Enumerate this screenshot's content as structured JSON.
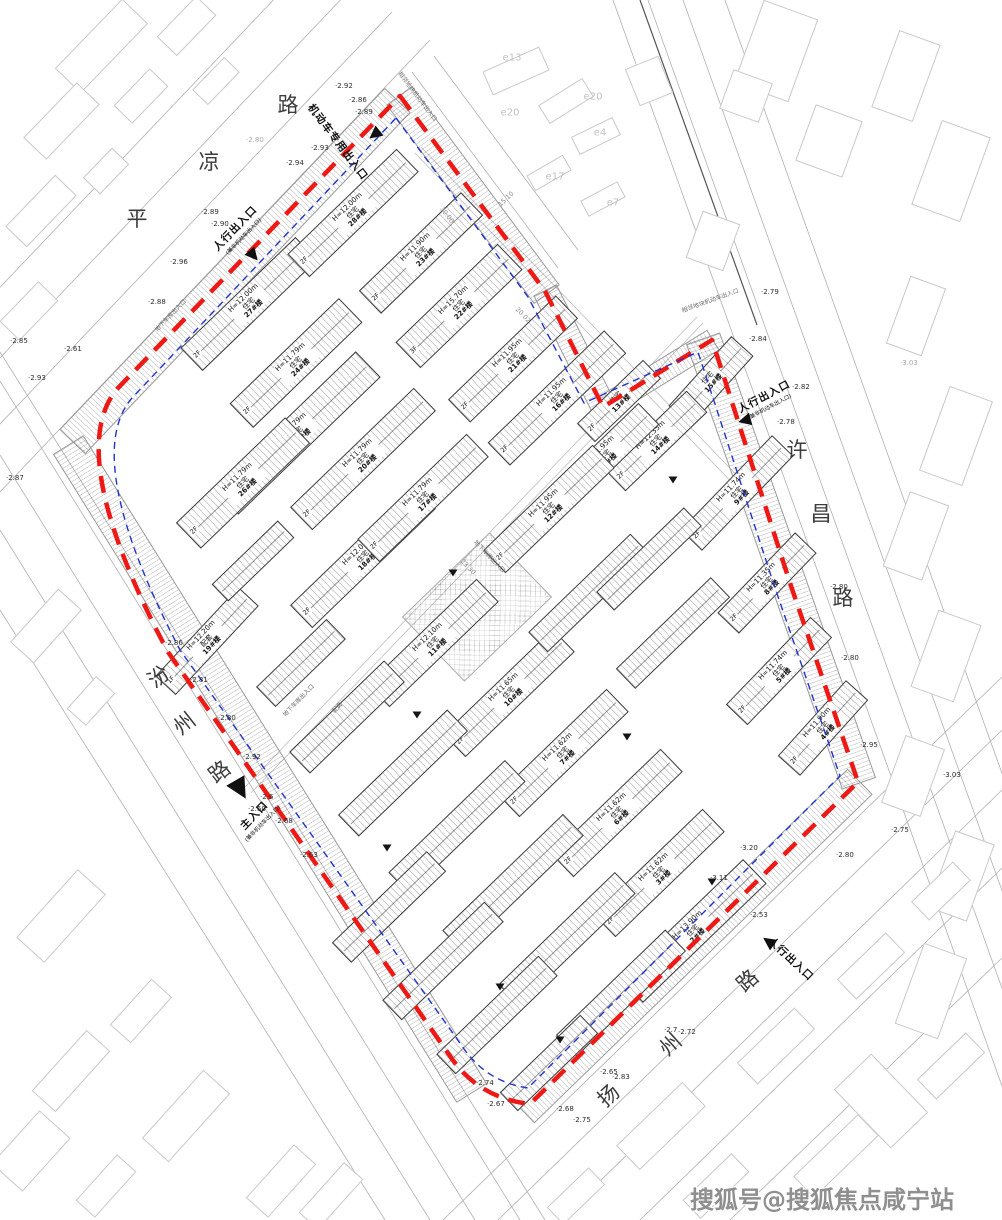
{
  "site": {
    "watermark": "搜狐号@搜狐焦点咸宁站"
  },
  "boundary": {
    "red_color": "#ee1814",
    "blue_color": "#2233cc",
    "red_path": "M400,96 L545,291 L603,407 L712,340 L790,583 L858,782 L530,1104 Q478,1098 450,1056 L168,652 Q62,452 118,388 Z",
    "blue_path": "M396,118 L528,297 L584,403 L698,352 L774,585 L840,776 L528,1088 Q486,1082 462,1046 L180,650 Q80,458 132,398 Z"
  },
  "roads": [
    {
      "name": "平凉路",
      "chars": [
        [
          "平",
          137,
          218,
          0
        ],
        [
          "凉",
          209,
          161,
          0
        ],
        [
          "路",
          288,
          104,
          0
        ]
      ]
    },
    {
      "name": "许昌路",
      "chars": [
        [
          "许",
          797,
          449,
          0
        ],
        [
          "昌",
          821,
          513,
          0
        ],
        [
          "路",
          843,
          597,
          0
        ]
      ]
    },
    {
      "name": "汾州路",
      "chars": [
        [
          "汾",
          158,
          676,
          -38
        ],
        [
          "州",
          184,
          723,
          -38
        ],
        [
          "路",
          219,
          771,
          -38
        ]
      ]
    },
    {
      "name": "扬州路",
      "chars": [
        [
          "扬",
          608,
          1095,
          -42
        ],
        [
          "州",
          670,
          1044,
          -42
        ],
        [
          "路",
          747,
          980,
          -42
        ]
      ]
    }
  ],
  "entrances": [
    {
      "label": "人行出入口",
      "sub": "(兼非机动车出入口)",
      "x": 238,
      "y": 231,
      "rot": -46,
      "tri": [
        253,
        255,
        140,
        13
      ]
    },
    {
      "label": "机动车专用出入口",
      "sub": "",
      "x": 338,
      "y": 142,
      "rot": 53,
      "tri": [
        374,
        134,
        232,
        13
      ]
    },
    {
      "label": "人行出入口",
      "sub": "(兼非机动车出入口)",
      "x": 766,
      "y": 400,
      "rot": -28,
      "tri": [
        744,
        420,
        255,
        13
      ]
    },
    {
      "label": "主入口",
      "sub": "(兼非机动车出入口)",
      "x": 257,
      "y": 818,
      "rot": -46,
      "tri": [
        240,
        789,
        150,
        21
      ]
    },
    {
      "label": "人行出入口",
      "sub": "",
      "x": 791,
      "y": 959,
      "rot": 43,
      "tri": [
        768,
        941,
        305,
        13
      ]
    }
  ],
  "buildings": [
    {
      "num": "27#楼",
      "use": "住宅",
      "h": "H=12.00m",
      "x": 248,
      "y": 303,
      "l": 158,
      "w": 30,
      "rot": -44,
      "fl": "2F"
    },
    {
      "num": "28#楼",
      "use": "住宅",
      "h": "H=12.00m",
      "x": 352,
      "y": 212,
      "l": 150,
      "w": 30,
      "rot": -44,
      "fl": "2F"
    },
    {
      "num": "23#楼",
      "use": "住宅",
      "h": "H=11.90m",
      "x": 420,
      "y": 252,
      "l": 140,
      "w": 30,
      "rot": -44,
      "fl": "2F"
    },
    {
      "num": "22#楼",
      "use": "住宅",
      "h": "H=15.70m",
      "x": 458,
      "y": 305,
      "l": 140,
      "w": 34,
      "rot": -44,
      "fl": "3F"
    },
    {
      "num": "21#楼",
      "use": "住宅",
      "h": "H=11.95m",
      "x": 512,
      "y": 358,
      "l": 148,
      "w": 30,
      "rot": -44,
      "fl": "2F"
    },
    {
      "num": "24#楼",
      "use": "住宅",
      "h": "H=11.79m",
      "x": 295,
      "y": 362,
      "l": 150,
      "w": 32,
      "rot": -44,
      "fl": "2F"
    },
    {
      "num": "25#楼",
      "use": "住宅",
      "h": "H=11.79m",
      "x": 296,
      "y": 432,
      "l": 196,
      "w": 34,
      "rot": -44,
      "fl": "2F"
    },
    {
      "num": "26#楼",
      "use": "住宅",
      "h": "H=11.79m",
      "x": 242,
      "y": 482,
      "l": 150,
      "w": 34,
      "rot": -44,
      "fl": "2F"
    },
    {
      "num": "20#楼",
      "use": "住宅",
      "h": "H=11.79m",
      "x": 362,
      "y": 458,
      "l": 170,
      "w": 30,
      "rot": -44,
      "fl": "2F"
    },
    {
      "num": "18#楼",
      "use": "住宅",
      "h": "H=12.00m",
      "x": 362,
      "y": 556,
      "l": 170,
      "w": 30,
      "rot": -44,
      "fl": "2F"
    },
    {
      "num": "17#楼",
      "use": "住宅",
      "h": "H=11.79m",
      "x": 422,
      "y": 497,
      "l": 150,
      "w": 30,
      "rot": -44,
      "fl": "2F"
    },
    {
      "num": "16#楼",
      "use": "住宅",
      "h": "H=11.95m",
      "x": 556,
      "y": 397,
      "l": 160,
      "w": 30,
      "rot": -44,
      "fl": "2F"
    },
    {
      "num": "15#楼",
      "use": "住宅",
      "h": "",
      "x": 710,
      "y": 380,
      "l": 92,
      "w": 28,
      "rot": -48,
      "fl": "3F"
    },
    {
      "num": "14#楼",
      "use": "住宅",
      "h": "H=12.35m",
      "x": 655,
      "y": 440,
      "l": 112,
      "w": 28,
      "rot": -44,
      "fl": "2F"
    },
    {
      "num": "13#楼",
      "use": "住宅",
      "h": "",
      "x": 618,
      "y": 400,
      "l": 90,
      "w": 24,
      "rot": -44,
      "fl": "2F"
    },
    {
      "num": "1#楼",
      "use": "住宅",
      "h": "H=11.95m",
      "x": 604,
      "y": 455,
      "l": 120,
      "w": 28,
      "rot": -44,
      "fl": "2F"
    },
    {
      "num": "12#楼",
      "use": "住宅",
      "h": "H=11.95m",
      "x": 548,
      "y": 508,
      "l": 150,
      "w": 30,
      "rot": -44,
      "fl": "2F"
    },
    {
      "num": "11#楼",
      "use": "住宅",
      "h": "H=12.10m",
      "x": 432,
      "y": 642,
      "l": 150,
      "w": 30,
      "rot": -44,
      "fl": "2F"
    },
    {
      "num": "10#楼",
      "use": "住宅",
      "h": "H=11.65m",
      "x": 508,
      "y": 692,
      "l": 150,
      "w": 30,
      "rot": -44,
      "fl": "2F"
    },
    {
      "num": "9#楼",
      "use": "住宅",
      "h": "H=11.74m",
      "x": 736,
      "y": 492,
      "l": 130,
      "w": 28,
      "rot": -46,
      "fl": "2F"
    },
    {
      "num": "8#楼",
      "use": "住宅",
      "h": "H=11.35m",
      "x": 766,
      "y": 582,
      "l": 110,
      "w": 28,
      "rot": -46,
      "fl": "2F"
    },
    {
      "num": "5#楼",
      "use": "住宅",
      "h": "H=11.74m",
      "x": 778,
      "y": 670,
      "l": 120,
      "w": 28,
      "rot": -46,
      "fl": "2F"
    },
    {
      "num": "4#楼",
      "use": "住宅",
      "h": "H=11.90m",
      "x": 822,
      "y": 727,
      "l": 100,
      "w": 28,
      "rot": -48,
      "fl": "2F"
    },
    {
      "num": "7#楼",
      "use": "住宅",
      "h": "H=11.62m",
      "x": 562,
      "y": 752,
      "l": 150,
      "w": 30,
      "rot": -44,
      "fl": "2F"
    },
    {
      "num": "6#楼",
      "use": "住宅",
      "h": "H=11.62m",
      "x": 616,
      "y": 812,
      "l": 150,
      "w": 30,
      "rot": -44,
      "fl": "2F"
    },
    {
      "num": "3#楼",
      "use": "住宅",
      "h": "H=11.62m",
      "x": 658,
      "y": 872,
      "l": 150,
      "w": 30,
      "rot": -44,
      "fl": "2F"
    },
    {
      "num": "2#楼",
      "use": "住宅",
      "h": "H=13.90m",
      "x": 692,
      "y": 930,
      "l": 170,
      "w": 32,
      "rot": -44,
      "fl": "3F"
    },
    {
      "num": "19#楼",
      "use": "配套",
      "h": "H=12.20m",
      "x": 206,
      "y": 640,
      "l": 120,
      "w": 26,
      "rot": -47,
      "fl": "1F"
    }
  ],
  "fillers": [
    [
      300,
      662,
      96,
      26,
      -44
    ],
    [
      346,
      716,
      130,
      28,
      -44
    ],
    [
      402,
      772,
      150,
      28,
      -44
    ],
    [
      456,
      826,
      160,
      28,
      -44
    ],
    [
      512,
      882,
      166,
      28,
      -44
    ],
    [
      566,
      938,
      160,
      28,
      -44
    ],
    [
      620,
      992,
      150,
      28,
      -44
    ],
    [
      388,
      906,
      130,
      26,
      -44
    ],
    [
      442,
      960,
      140,
      26,
      -44
    ],
    [
      496,
      1014,
      140,
      26,
      -44
    ],
    [
      548,
      1062,
      110,
      24,
      -44
    ],
    [
      672,
      632,
      130,
      26,
      -44
    ],
    [
      588,
      592,
      140,
      26,
      -44
    ],
    [
      648,
      558,
      120,
      24,
      -44
    ],
    [
      252,
      560,
      90,
      22,
      -44
    ]
  ],
  "belts": [
    [
      234,
      270,
      470,
      34,
      -46.4
    ],
    [
      472,
      194,
      246,
      30,
      53.4
    ],
    [
      574,
      349,
      132,
      24,
      63.4
    ],
    [
      657,
      373,
      128,
      22,
      -31.6
    ],
    [
      780,
      560,
      470,
      34,
      70.7
    ],
    [
      690,
      945,
      470,
      34,
      -44.2
    ],
    [
      269,
      768,
      762,
      34,
      58.1
    ]
  ],
  "plaza": [
    476,
    606,
    120,
    88,
    -44
  ],
  "elevations": [
    [
      337,
      86,
      "2.92",
      0
    ],
    [
      351,
      100,
      "2.86",
      0
    ],
    [
      357,
      112,
      "2.89",
      0
    ],
    [
      313,
      148,
      "2.93",
      0
    ],
    [
      288,
      163,
      "2.94",
      0
    ],
    [
      203,
      212,
      "2.89",
      0
    ],
    [
      213,
      224,
      "2.90",
      0
    ],
    [
      172,
      262,
      "2.96",
      0
    ],
    [
      150,
      302,
      "2.88",
      0
    ],
    [
      12,
      341,
      "2.85",
      0
    ],
    [
      66,
      349,
      "2.61",
      0
    ],
    [
      30,
      378,
      "2.93",
      0
    ],
    [
      8,
      478,
      "2.87",
      0
    ],
    [
      167,
      643,
      "2.86",
      0
    ],
    [
      192,
      680,
      "2.81",
      0
    ],
    [
      220,
      718,
      "2.80",
      0
    ],
    [
      245,
      757,
      "2.92",
      0
    ],
    [
      262,
      797,
      "2.6",
      0
    ],
    [
      250,
      809,
      "2.60",
      0
    ],
    [
      277,
      821,
      "2.68",
      0
    ],
    [
      302,
      855,
      "2.63",
      0
    ],
    [
      478,
      1083,
      "2.74",
      0
    ],
    [
      489,
      1104,
      "2.67",
      0
    ],
    [
      558,
      1109,
      "2.68",
      0
    ],
    [
      575,
      1120,
      "2.75",
      0
    ],
    [
      602,
      1072,
      "2.65",
      0
    ],
    [
      614,
      1077,
      "2.83",
      0
    ],
    [
      666,
      1030,
      "2.7",
      0
    ],
    [
      680,
      1032,
      "2.72",
      0
    ],
    [
      752,
      915,
      "2.53",
      0
    ],
    [
      838,
      855,
      "2.80",
      0
    ],
    [
      893,
      830,
      "2.75",
      0
    ],
    [
      862,
      745,
      "2.95",
      0
    ],
    [
      945,
      775,
      "3.03",
      0
    ],
    [
      763,
      292,
      "2.79",
      0
    ],
    [
      751,
      339,
      "2.84",
      0
    ],
    [
      794,
      387,
      "2.82",
      0
    ],
    [
      779,
      422,
      "2.78",
      0
    ],
    [
      832,
      587,
      "2.80",
      0
    ],
    [
      843,
      658,
      "2.80",
      0
    ],
    [
      902,
      363,
      "3.03",
      1
    ],
    [
      248,
      140,
      "2.80",
      1
    ],
    [
      742,
      848,
      "3.20",
      0
    ],
    [
      712,
      878,
      "3.11",
      0
    ]
  ],
  "dims": [
    [
      506,
      199,
      -44,
      "15.10"
    ],
    [
      523,
      315,
      46,
      "20.02"
    ],
    [
      468,
      567,
      46,
      "23.30"
    ],
    [
      447,
      215,
      53,
      "30.00"
    ]
  ],
  "markers": [
    [
      453,
      573
    ],
    [
      417,
      715
    ],
    [
      387,
      848
    ],
    [
      673,
      480
    ],
    [
      712,
      882
    ],
    [
      500,
      987
    ],
    [
      627,
      737
    ],
    [
      560,
      1040
    ]
  ],
  "ext_labels": [
    [
      512,
      58,
      "e13"
    ],
    [
      510,
      113,
      "e20"
    ],
    [
      593,
      97,
      "e20"
    ],
    [
      600,
      133,
      "e4"
    ],
    [
      555,
      177,
      "e17"
    ],
    [
      613,
      203,
      "e7"
    ]
  ],
  "annotations": [
    [
      418,
      96,
      53,
      "相邻地块机动车出入口"
    ],
    [
      710,
      300,
      -20,
      "相邻地块机动车出入口"
    ],
    [
      298,
      700,
      -46,
      "地下车库出入口"
    ],
    [
      490,
      556,
      46,
      "地下车库出入口"
    ],
    [
      337,
      707,
      -46,
      "配套"
    ],
    [
      170,
      315,
      -46,
      "地下车库出入口"
    ]
  ],
  "linework": {
    "outside": [
      [
        430,
        40,
        -40,
        534
      ],
      [
        392,
        12,
        -78,
        506
      ],
      [
        348,
        -8,
        -122,
        486
      ],
      [
        300,
        -28,
        -170,
        466
      ],
      [
        412,
        72,
        558,
        268
      ],
      [
        434,
        56,
        578,
        250
      ],
      [
        613,
        0,
        1050,
        1220
      ],
      [
        648,
        0,
        1085,
        1220
      ],
      [
        683,
        0,
        1120,
        1220
      ],
      [
        725,
        0,
        1162,
        1220
      ],
      [
        0,
        352,
        545,
        1220
      ],
      [
        0,
        381,
        520,
        1220
      ],
      [
        0,
        455,
        475,
        1220
      ],
      [
        0,
        530,
        430,
        1220
      ],
      [
        0,
        610,
        385,
        1220
      ],
      [
        443,
        1220,
        1002,
        677
      ],
      [
        498,
        1220,
        1002,
        730
      ],
      [
        560,
        1220,
        1002,
        790
      ],
      [
        640,
        1220,
        1002,
        868
      ],
      [
        730,
        1220,
        1002,
        958
      ]
    ],
    "outside_dark": [
      [
        640,
        0,
        757,
        325
      ]
    ],
    "internal": [
      [
        415,
        153,
        742,
        493
      ],
      [
        421,
        147,
        748,
        487
      ],
      [
        245,
        787,
        697,
        317
      ],
      [
        251,
        793,
        703,
        323
      ]
    ]
  },
  "outside_blocks": [
    [
      100,
      45,
      95,
      34,
      -46
    ],
    [
      185,
      25,
      55,
      26,
      -46
    ],
    [
      60,
      120,
      75,
      30,
      -46
    ],
    [
      140,
      95,
      50,
      24,
      -46
    ],
    [
      40,
      210,
      70,
      28,
      -46
    ],
    [
      105,
      170,
      40,
      22,
      -46
    ],
    [
      28,
      310,
      54,
      26,
      -46
    ],
    [
      215,
      80,
      44,
      20,
      -46
    ],
    [
      45,
      625,
      70,
      30,
      -48
    ],
    [
      90,
      700,
      42,
      24,
      -48
    ],
    [
      60,
      915,
      90,
      36,
      -48
    ],
    [
      140,
      1010,
      60,
      26,
      -48
    ],
    [
      70,
      1070,
      80,
      30,
      -48
    ],
    [
      185,
      1115,
      90,
      34,
      -48
    ],
    [
      280,
      1180,
      70,
      28,
      -48
    ],
    [
      105,
      1185,
      60,
      24,
      -48
    ],
    [
      30,
      1150,
      70,
      40,
      -48
    ],
    [
      905,
      75,
      42,
      80,
      20
    ],
    [
      950,
      170,
      50,
      88,
      20
    ],
    [
      915,
      315,
      36,
      70,
      20
    ],
    [
      955,
      435,
      44,
      88,
      20
    ],
    [
      915,
      535,
      40,
      78,
      20
    ],
    [
      945,
      655,
      44,
      80,
      20
    ],
    [
      912,
      775,
      40,
      70,
      20
    ],
    [
      960,
      875,
      40,
      80,
      20
    ],
    [
      930,
      990,
      44,
      84,
      20
    ],
    [
      880,
      1100,
      50,
      80,
      -44
    ],
    [
      515,
      70,
      60,
      24,
      -24
    ],
    [
      565,
      100,
      50,
      20,
      -32
    ],
    [
      595,
      135,
      44,
      18,
      -26
    ],
    [
      548,
      172,
      40,
      16,
      -30
    ],
    [
      602,
      198,
      40,
      16,
      -28
    ],
    [
      648,
      80,
      34,
      38,
      -22
    ],
    [
      775,
      50,
      56,
      86,
      20
    ],
    [
      828,
      140,
      48,
      58,
      20
    ],
    [
      712,
      240,
      38,
      48,
      20
    ],
    [
      745,
      95,
      40,
      40,
      20
    ],
    [
      660,
      1125,
      90,
      32,
      -44
    ],
    [
      775,
      1045,
      78,
      28,
      -44
    ],
    [
      870,
      965,
      66,
      26,
      -44
    ],
    [
      940,
      890,
      56,
      24,
      -44
    ],
    [
      715,
      1185,
      66,
      24,
      -44
    ],
    [
      835,
      1155,
      88,
      28,
      -44
    ],
    [
      950,
      1065,
      66,
      26,
      -44
    ],
    [
      575,
      1195,
      56,
      22,
      -44
    ],
    [
      330,
      1195,
      66,
      24,
      -48
    ]
  ]
}
